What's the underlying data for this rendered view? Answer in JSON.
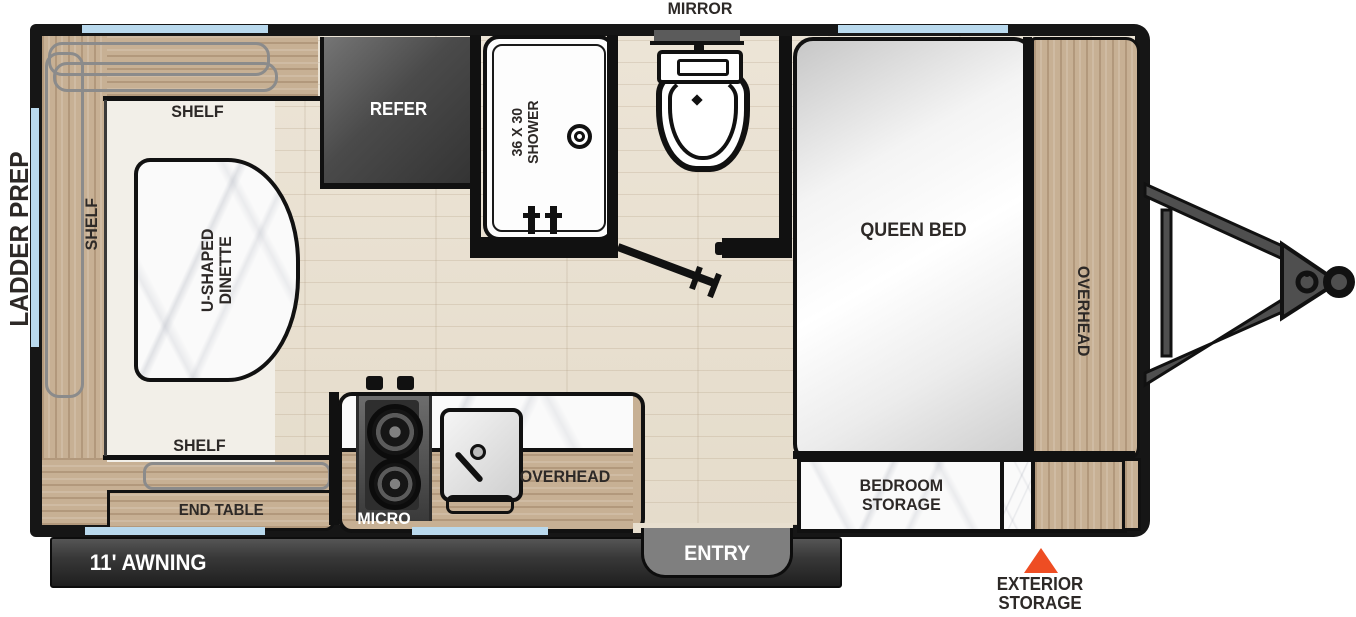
{
  "exterior": {
    "mirror": "MIRROR",
    "ladder_prep": "LADDER PREP",
    "awning": "11' AWNING",
    "entry": "ENTRY",
    "exterior_storage": "EXTERIOR\nSTORAGE"
  },
  "living": {
    "shelf_top": "SHELF",
    "shelf_left": "SHELF",
    "shelf_bottom": "SHELF",
    "dinette": "U-SHAPED\nDINETTE",
    "end_table": "END TABLE"
  },
  "kitchen": {
    "refer": "REFER",
    "micro": "MICRO",
    "overhead": "OVERHEAD"
  },
  "bath": {
    "shower": "36 X 30\nSHOWER"
  },
  "bedroom": {
    "bed": "QUEEN BED",
    "overhead": "OVERHEAD",
    "storage": "BEDROOM\nSTORAGE"
  },
  "colors": {
    "accent_orange": "#ee4d23",
    "window_blue": "#b9d9ed",
    "wall_black": "#161616",
    "wood_tan": "#c7b094",
    "floor_beige": "#eae1d2",
    "label_charcoal": "#2d2927"
  }
}
